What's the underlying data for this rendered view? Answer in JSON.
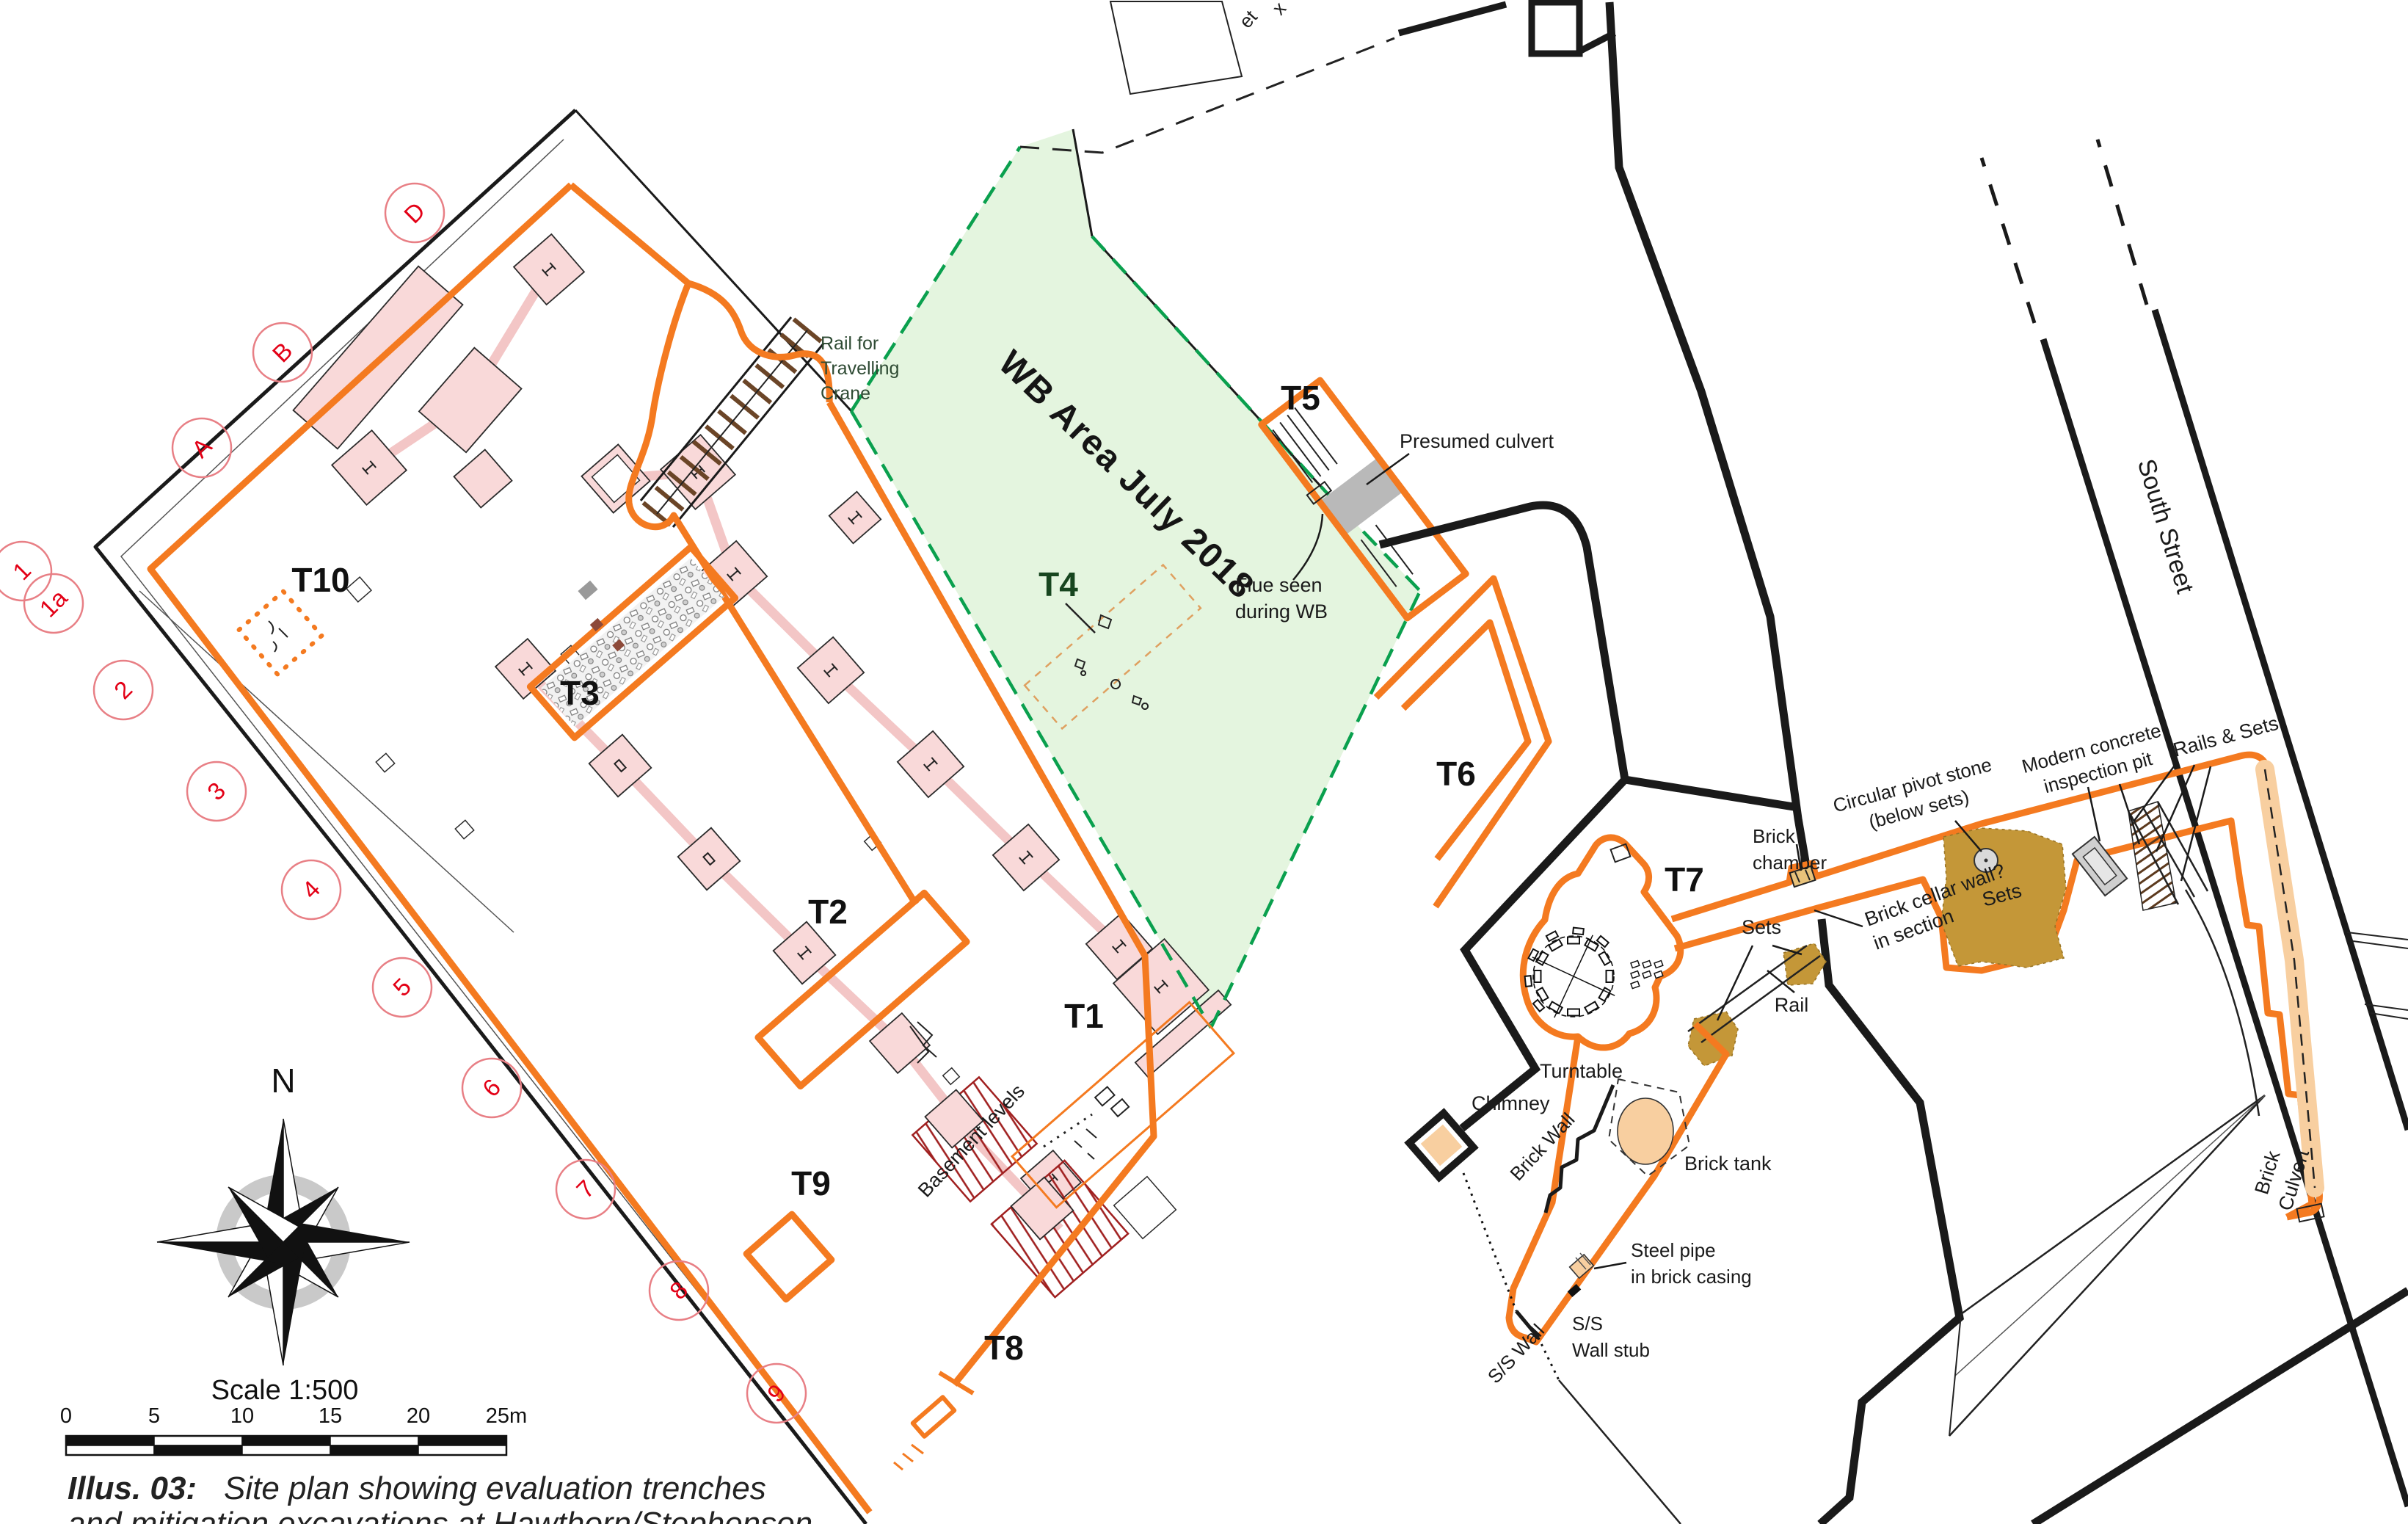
{
  "caption": {
    "prefix": "Illus. 03:",
    "line1": " Site plan showing evaluation trenches",
    "line2": "and mitigation excavations at Hawthorn/Stephenson"
  },
  "compass": {
    "north": "N"
  },
  "scalebar": {
    "title": "Scale 1:500",
    "ticks": [
      "0",
      "5",
      "10",
      "15",
      "20",
      "25m"
    ]
  },
  "streets": {
    "south_street": "South Street"
  },
  "areas": {
    "wb_area": "WB Area July 2018"
  },
  "trenches": [
    {
      "id": "T1",
      "label": "T1"
    },
    {
      "id": "T2",
      "label": "T2"
    },
    {
      "id": "T3",
      "label": "T3"
    },
    {
      "id": "T4",
      "label": "T4"
    },
    {
      "id": "T5",
      "label": "T5"
    },
    {
      "id": "T6",
      "label": "T6"
    },
    {
      "id": "T7",
      "label": "T7"
    },
    {
      "id": "T8",
      "label": "T8"
    },
    {
      "id": "T9",
      "label": "T9"
    },
    {
      "id": "T10",
      "label": "T10"
    }
  ],
  "annotations": {
    "rail_crane_l1": "Rail for",
    "rail_crane_l2": "Travelling",
    "rail_crane_l3": "Crane",
    "presumed_culvert": "Presumed culvert",
    "flue_l1": "Flue seen",
    "flue_l2": "during WB",
    "basement_levels": "Basement levels",
    "turntable": "Turntable",
    "brick_chamber_l1": "Brick",
    "brick_chamber_l2": "chamber",
    "pivot_l1": "Circular pivot stone",
    "pivot_l2": "(below sets)",
    "inspection_l1": "Modern concrete",
    "inspection_l2": "inspection pit",
    "rails_sets": "Rails & Sets",
    "sets_big": "Sets",
    "sets_small": "Sets",
    "rail": "Rail",
    "cellar_l1": "Brick cellar wall?",
    "cellar_l2": "in section",
    "brick_culvert_l1": "Brick",
    "brick_culvert_l2": "Culvert",
    "chimney": "Chimney",
    "brick_wall": "Brick Wall",
    "brick_tank": "Brick tank",
    "steel_pipe_l1": "Steel pipe",
    "steel_pipe_l2": "in brick casing",
    "ss_stub_l1": "S/S",
    "ss_stub_l2": "Wall stub",
    "ss_wall": "S/S Wall",
    "frag_1": "et",
    "frag_2": "x"
  },
  "grid": {
    "letters": [
      "A",
      "B",
      "D"
    ],
    "numbers": [
      "1",
      "1a",
      "2",
      "3",
      "4",
      "5",
      "6",
      "7",
      "8",
      "9"
    ]
  },
  "colors": {
    "orange": "#f47a20",
    "pink_fill": "#f9d9d9",
    "strip": "#f3c6c6",
    "green_fill": "#e4f5df",
    "green_line": "#0aa04e",
    "dark_green_text": "#17461f",
    "wall": "#1a1a1a",
    "red_hatch": "#a02020",
    "circle_red": "#e87f85",
    "red_text": "#e30016",
    "tan": "#c49738",
    "peach": "#f8cfa0",
    "gray": "#b9b9b9",
    "tie_brown": "#6b4527"
  }
}
